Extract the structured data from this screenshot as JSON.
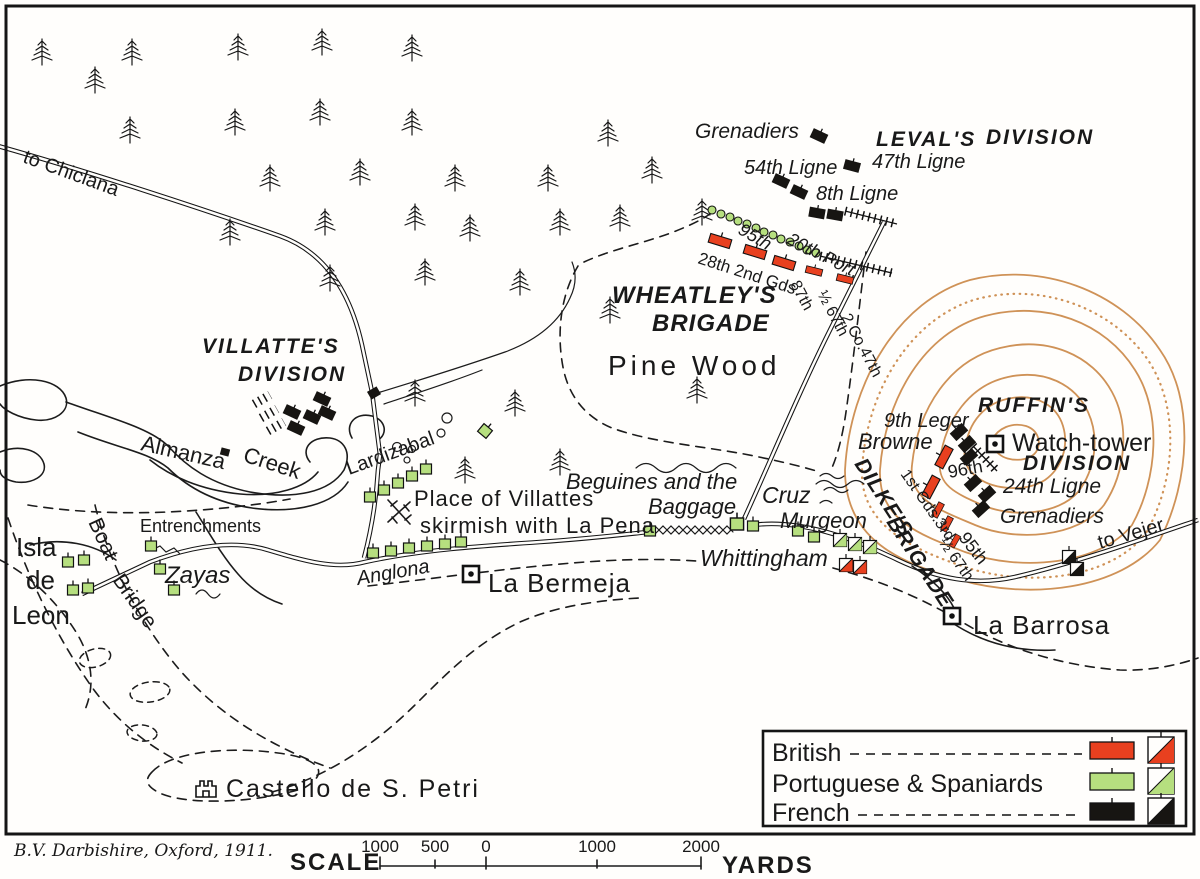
{
  "labels": {
    "to_chiclana": "to Chiclana",
    "grenadiers_leval": "Grenadiers",
    "levals": "LEVAL'S",
    "levals_division": "DIVISION",
    "ligne_54": "54th Ligne",
    "ligne_47": "47th Ligne",
    "ligne_8": "8th Ligne",
    "rifles_95": "95th",
    "port_20": "20th Port.",
    "wheatley_28_2gds": "28th 2nd Gds.",
    "wheatley_87": "87th",
    "wheatley_half_67": "½ 67th",
    "wheatley_2co47": "2 Co.47th",
    "wheatleys": "WHEATLEY'S",
    "wheatleys_brigade": "BRIGADE",
    "pine_wood": "Pine Wood",
    "villattes": "VILLATTE'S",
    "villattes_division": "DIVISION",
    "almanza": "Almanza",
    "creek": "Creek",
    "lardizabal": "Lardizabal",
    "entrenchments": "Entrenchments",
    "zayas": "Zayas",
    "isla": "Isla",
    "isla_de": "de",
    "isla_leon": "Leon",
    "boat": "Boat",
    "bridge": "Bridge",
    "castello": "Castello de S. Petri",
    "anglona": "Anglona",
    "la_bermeja": "La Bermeja",
    "place_line1": "Place of Villattes",
    "place_line2": "skirmish with La Pena",
    "beguines_line1": "Beguines and the",
    "beguines_line2": "Baggage",
    "cruz": "Cruz",
    "murgeon": "Murgeon",
    "whittingham": "Whittingham",
    "dilkes": "DILKE'S",
    "dilkes_brigade": "BRIGADE",
    "dilke_units_a": "1st Gds.3rd",
    "dilke_units_b": "½ 67th",
    "dilke_95": "95th",
    "browne": "Browne",
    "leger_9": "9th Leger",
    "ligne_96": "96th",
    "ruffins": "RUFFIN'S",
    "ruffins_division": "DIVISION",
    "watch_tower": "Watch-tower",
    "ligne_24": "24th Ligne",
    "grenadiers_ruffin": "Grenadiers",
    "to_vejer": "to Vejer",
    "la_barrosa": "La Barrosa"
  },
  "legend": {
    "items": [
      {
        "label": "British",
        "color": "#e8401f"
      },
      {
        "label": "Portuguese & Spaniards",
        "color": "#b6df7f"
      },
      {
        "label": "French",
        "color": "#171512"
      }
    ]
  },
  "scale": {
    "title": "SCALE",
    "unit": "YARDS",
    "ticks": [
      "1000",
      "500",
      "0",
      "1000",
      "2000"
    ]
  },
  "signature": "B.V. Darbishire, Oxford, 1911.",
  "colors": {
    "british": "#e8401f",
    "portuguese_spanish": "#b6df7f",
    "french": "#171512",
    "contour": "#cf9257",
    "paper": "#fffefc"
  }
}
